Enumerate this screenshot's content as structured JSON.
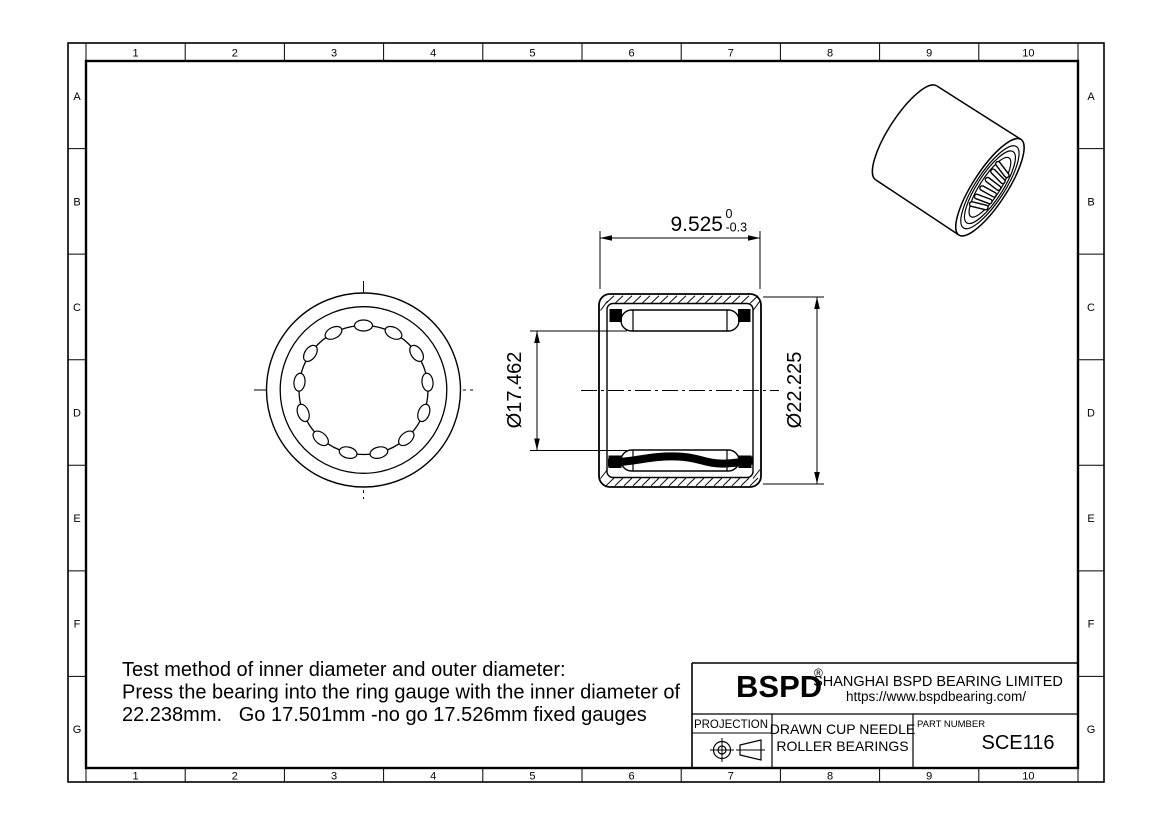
{
  "border": {
    "columns": [
      "1",
      "2",
      "3",
      "4",
      "5",
      "6",
      "7",
      "8",
      "9",
      "10"
    ],
    "rows": [
      "A",
      "B",
      "C",
      "D",
      "E",
      "F",
      "G"
    ]
  },
  "dimensions": {
    "width_value": "9.525",
    "width_tol_upper": "0",
    "width_tol_lower": "-0.3",
    "bore_value": "Ø17.462",
    "outer_value": "Ø22.225"
  },
  "notes": {
    "line1": "Test method of inner diameter and outer diameter:",
    "line2": "Press the bearing into the ring gauge with the inner diameter of",
    "line3": "22.238mm.   Go 17.501mm -no go 17.526mm fixed gauges"
  },
  "title_block": {
    "brand": "BSPD",
    "registered": "®",
    "company": "SHANGHAI BSPD BEARING LIMITED",
    "website": "https://www.bspdbearing.com/",
    "projection_label": "PROJECTION",
    "product_line1": "DRAWN CUP NEEDLE",
    "product_line2": "ROLLER BEARINGS",
    "part_number_label": "PART NUMBER",
    "part_number": "SCE116"
  },
  "colors": {
    "ink": "#000000",
    "paper": "#ffffff"
  }
}
